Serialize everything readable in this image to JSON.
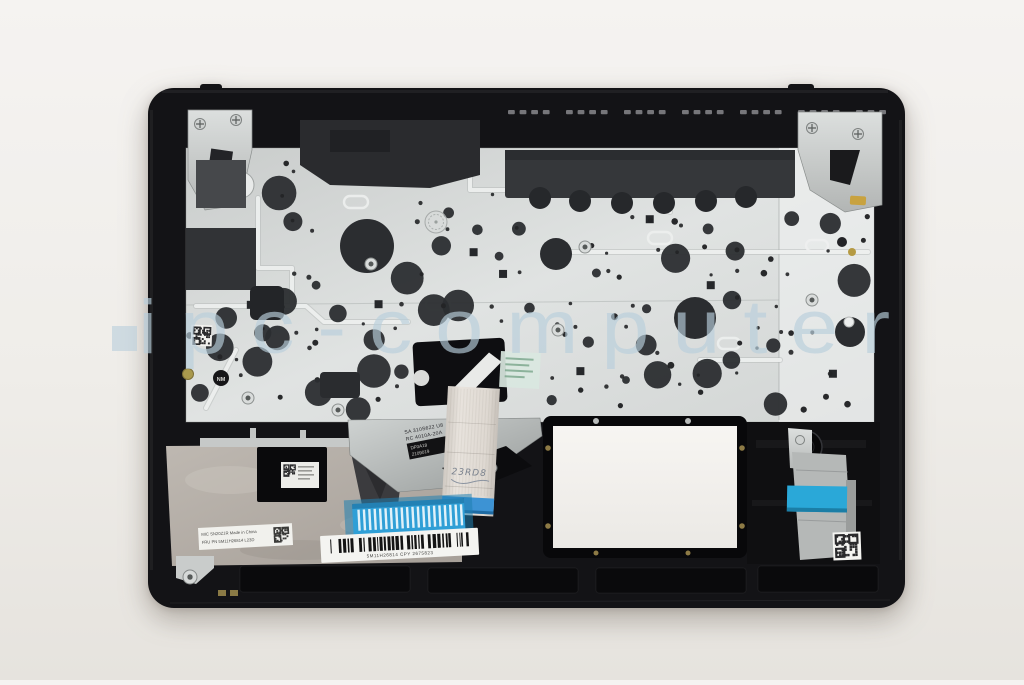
{
  "photo": {
    "watermark_text": "ipc-computer",
    "colors": {
      "watermark": "#b9cfdc",
      "tape_blue": "#2aa8d8",
      "chassis_black": "#131316",
      "plate_silver": "#d8dbda"
    },
    "markings": {
      "engraved_label": [
        "SA 310S622 U8",
        "RC 4010A-20A"
      ],
      "engraved_box": [
        "DF0A18",
        "2109019"
      ],
      "handwritten": "23RD8",
      "stamp_nm": "NM",
      "mic_label": [
        "MIC SN20Z1R Made in China",
        "FRU PN 5M11H26814 L23D"
      ],
      "barcode_text": "5M11H26814 CPY 2675823"
    }
  }
}
